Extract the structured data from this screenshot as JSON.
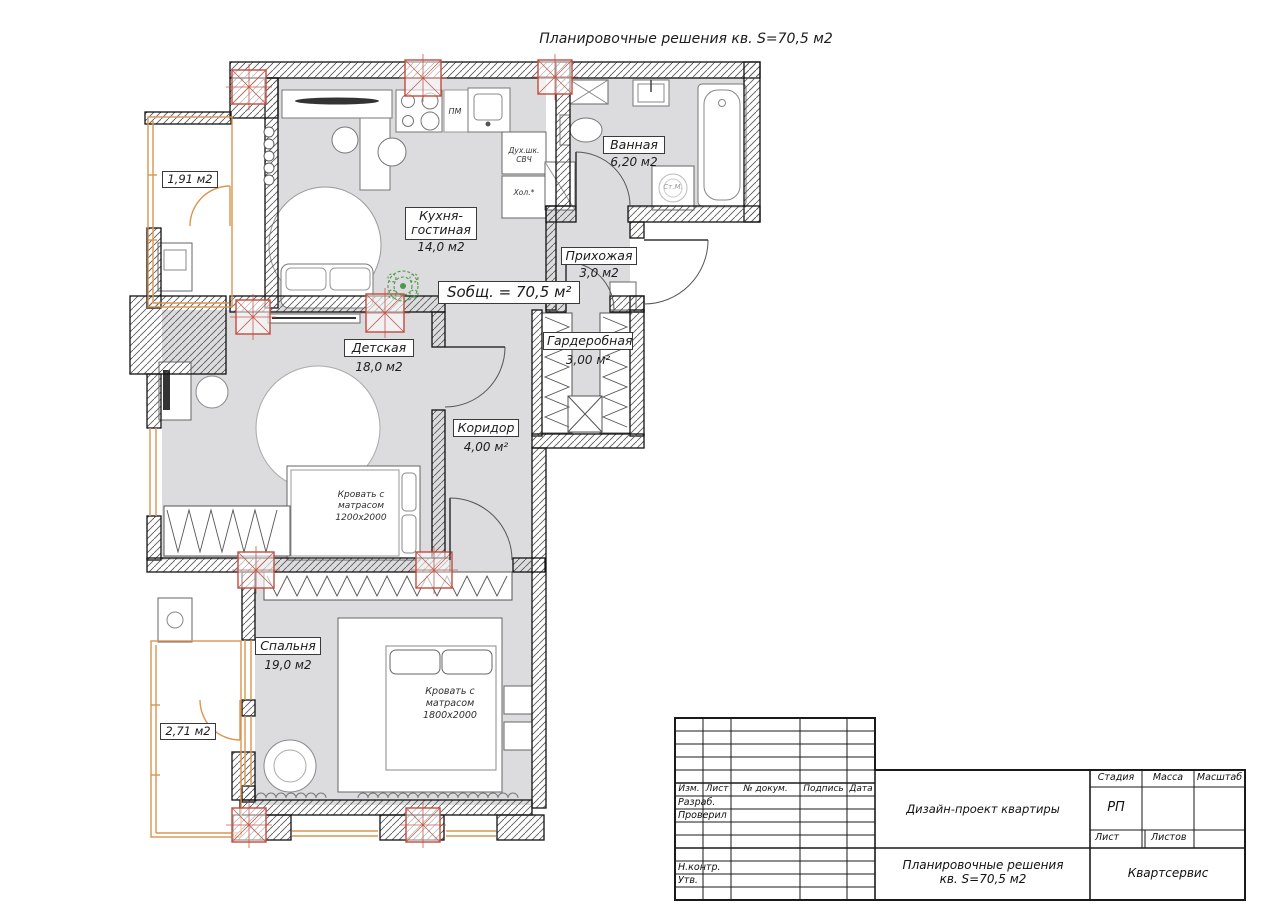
{
  "page": {
    "title": "Планировочные решения кв. S=70,5 м2"
  },
  "plan": {
    "total_area": "Sобщ. = 70,5 м²",
    "rooms": {
      "kitchen": {
        "name": "Кухня-гостиная",
        "area": "14,0 м2"
      },
      "bathroom": {
        "name": "Ванная",
        "area": "6,20 м2"
      },
      "hallway": {
        "name": "Прихожая",
        "area": "3,0 м2"
      },
      "kids": {
        "name": "Детская",
        "area": "18,0 м2"
      },
      "wardrobe": {
        "name": "Гардеробная",
        "area": "3,00 м²"
      },
      "corridor": {
        "name": "Коридор",
        "area": "4,00 м²"
      },
      "bedroom": {
        "name": "Спальня",
        "area": "19,0 м2"
      }
    },
    "balcony_top_area": "1,91 м2",
    "balcony_bottom_area": "2,71 м2",
    "labels": {
      "bed_kids": [
        "Кровать с",
        "матрасом",
        "1200х2000"
      ],
      "bed_main": [
        "Кровать с",
        "матрасом",
        "1800х2000"
      ],
      "dishwasher": "ПМ",
      "oven": [
        "Дух.шк.",
        "СВЧ"
      ],
      "fridge": "Хол.*",
      "washer": "Ст.М."
    },
    "colors": {
      "floor": "#dcdcde",
      "window_frame": "#d99550",
      "column_marker": "#c24b3e",
      "plant": "#4a9a4a"
    }
  },
  "title_block": {
    "col_izm": "Изм.",
    "col_list": "Лист",
    "col_doc": "№ докум.",
    "col_sign": "Подпись",
    "col_date": "Дата",
    "row_razrab": "Разраб.",
    "row_proveril": "Проверил",
    "row_nkontr": "Н.контр.",
    "row_utv": "Утв.",
    "project_name": "Дизайн-проект квартиры",
    "stage_label": "Стадия",
    "mass_label": "Масса",
    "scale_label": "Масштаб",
    "stage_value": "РП",
    "sheet_label": "Лист",
    "sheets_label": "Листов",
    "doc_line1": "Планировочные решения",
    "doc_line2": "кв. S=70,5 м2",
    "company": "Квартсервис"
  }
}
